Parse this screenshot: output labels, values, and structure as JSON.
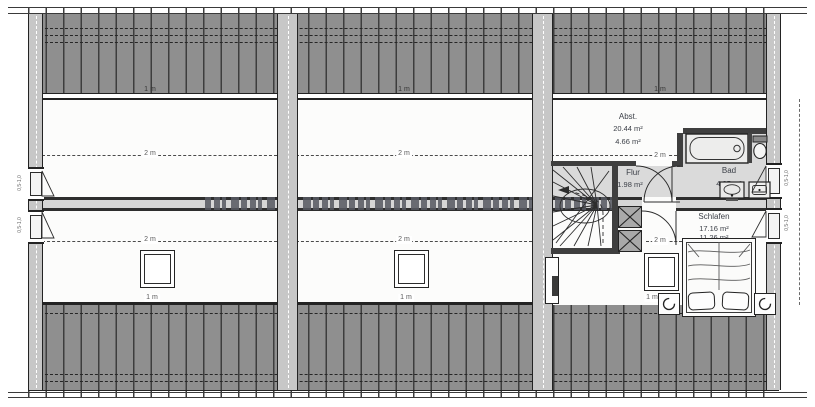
{
  "rooms": {
    "abst": {
      "name": "Abst.",
      "area_total": "20.44 m²",
      "area_reduced": "4.66 m²"
    },
    "flur": {
      "name": "Flur",
      "area": "1.98 m²"
    },
    "bad": {
      "name": "Bad",
      "area": "4.85 m²"
    },
    "schlafen": {
      "name": "Schlafen",
      "area_total": "17.16 m²",
      "area_reduced": "11.26 m²"
    }
  },
  "dims": {
    "one_meter": "1 m",
    "two_meter": "2 m",
    "window_mark": "0,5-1,0"
  },
  "colors": {
    "roof-fill": "#8f8f8f",
    "rafter": "#3d3d3d",
    "wall-fill": "#c7c7c7",
    "room-gray": "#dadada",
    "line-dark": "#232323",
    "dash": "#4a4a4a",
    "text": "#3b3f47",
    "dim-text": "#5a5a5a",
    "beam-fill": "#d6d6d6",
    "watermark": "#565861"
  }
}
